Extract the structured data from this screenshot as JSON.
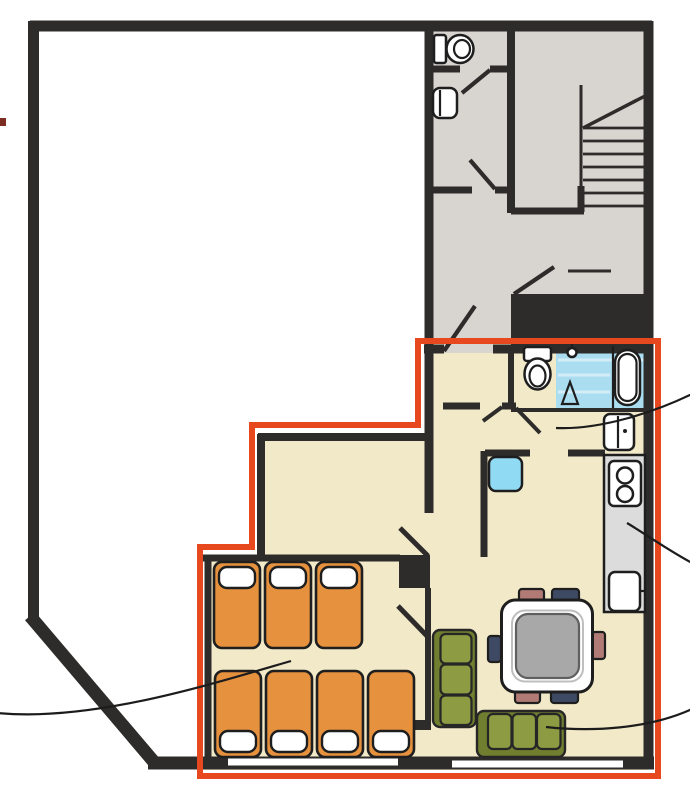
{
  "colors": {
    "wall": "#2e2c2a",
    "outline_red": "#e8481d",
    "floor_gray": "#d8d4d0",
    "floor_beige": "#f2e9c8",
    "water_blue": "#abddf1",
    "water_blue_light": "#d3edf8",
    "appliance_cyan": "#90daf3",
    "bed_orange": "#e5913d",
    "sofa_green": "#8d9b42",
    "sofa_green_dark": "#707e2f",
    "chair_mauve": "#b17a75",
    "chair_navy": "#3e4a64",
    "table_gray": "#a8a8a8",
    "counter_gray": "#dcdcdc",
    "leader_black": "#1c1c1c",
    "marker_maroon": "#7c2d21",
    "fixture_white": "#ffffff"
  },
  "plan": {
    "type": "apartment-floor-plan",
    "highlighted_unit": {
      "outlined_in_red": true,
      "rooms": [
        "entry-hall",
        "bathroom",
        "kitchen-dining",
        "living-area",
        "bedroom"
      ],
      "bed_count": 7,
      "bed_rows": [
        3,
        4
      ],
      "sofa_count": 2,
      "dining_chair_count": 6,
      "fixtures": [
        "toilet",
        "shower",
        "bathtub",
        "washbasin",
        "washing-machine",
        "stove",
        "kitchen-sink",
        "dining-table"
      ]
    },
    "common_area": {
      "rooms": [
        "wc",
        "washroom",
        "corridor",
        "stairwell",
        "landing"
      ],
      "fixtures": [
        "toilet",
        "washbasin",
        "staircase"
      ]
    },
    "callout_line_count": 4
  }
}
